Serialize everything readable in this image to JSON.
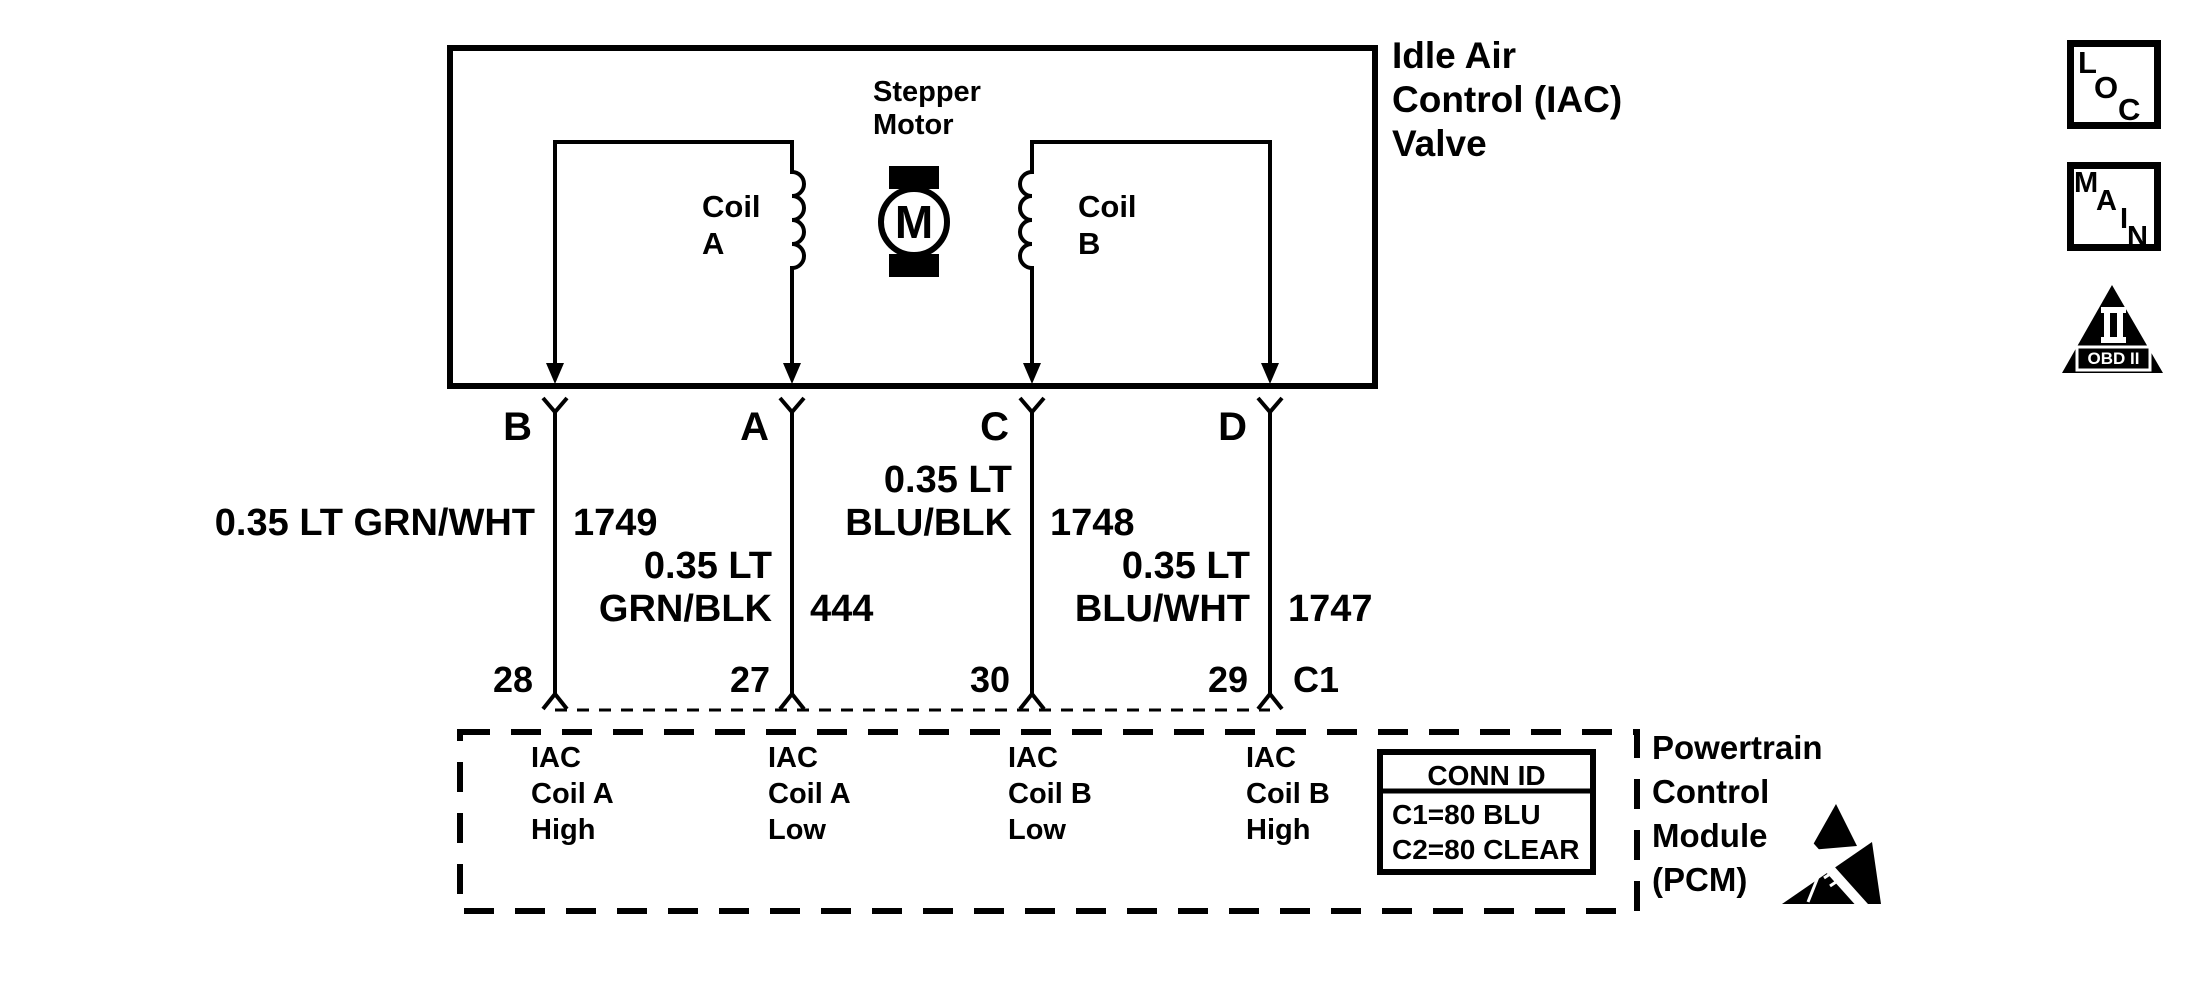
{
  "iac_valve": {
    "name_lines": [
      "Idle Air",
      "Control (IAC)",
      "Valve"
    ],
    "stepper_lines": [
      "Stepper",
      "Motor"
    ],
    "motor_letter": "M",
    "coil_a_lines": [
      "Coil",
      "A"
    ],
    "coil_b_lines": [
      "Coil",
      "B"
    ],
    "terminals": {
      "b": "B",
      "a": "A",
      "c": "C",
      "d": "D"
    }
  },
  "wires": {
    "b": {
      "label": "0.35 LT GRN/WHT",
      "circuit": "1749",
      "pin": "28"
    },
    "a": {
      "label_line1": "0.35 LT",
      "label_line2": "GRN/BLK",
      "circuit": "444",
      "pin": "27"
    },
    "c": {
      "label_line1": "0.35 LT",
      "label_line2": "BLU/BLK",
      "circuit": "1748",
      "pin": "30"
    },
    "d": {
      "label_line1": "0.35 LT",
      "label_line2": "BLU/WHT",
      "circuit": "1747",
      "pin": "29"
    }
  },
  "connector": {
    "id": "C1"
  },
  "pcm": {
    "name_lines": [
      "Powertrain",
      "Control",
      "Module",
      "(PCM)"
    ],
    "pin_b_lines": [
      "IAC",
      "Coil A",
      "High"
    ],
    "pin_a_lines": [
      "IAC",
      "Coil A",
      "Low"
    ],
    "pin_c_lines": [
      "IAC",
      "Coil B",
      "Low"
    ],
    "pin_d_lines": [
      "IAC",
      "Coil B",
      "High"
    ],
    "conn_table": {
      "header": "CONN ID",
      "row1": "C1=80 BLU",
      "row2": "C2=80 CLEAR"
    }
  },
  "badges": {
    "loc": {
      "l": "L",
      "o": "O",
      "c": "C"
    },
    "main": {
      "m": "M",
      "a": "A",
      "i": "I",
      "n": "N"
    },
    "obd": {
      "label": "OBD II"
    }
  },
  "colors": {
    "ink": "#000000",
    "paper": "#ffffff"
  }
}
